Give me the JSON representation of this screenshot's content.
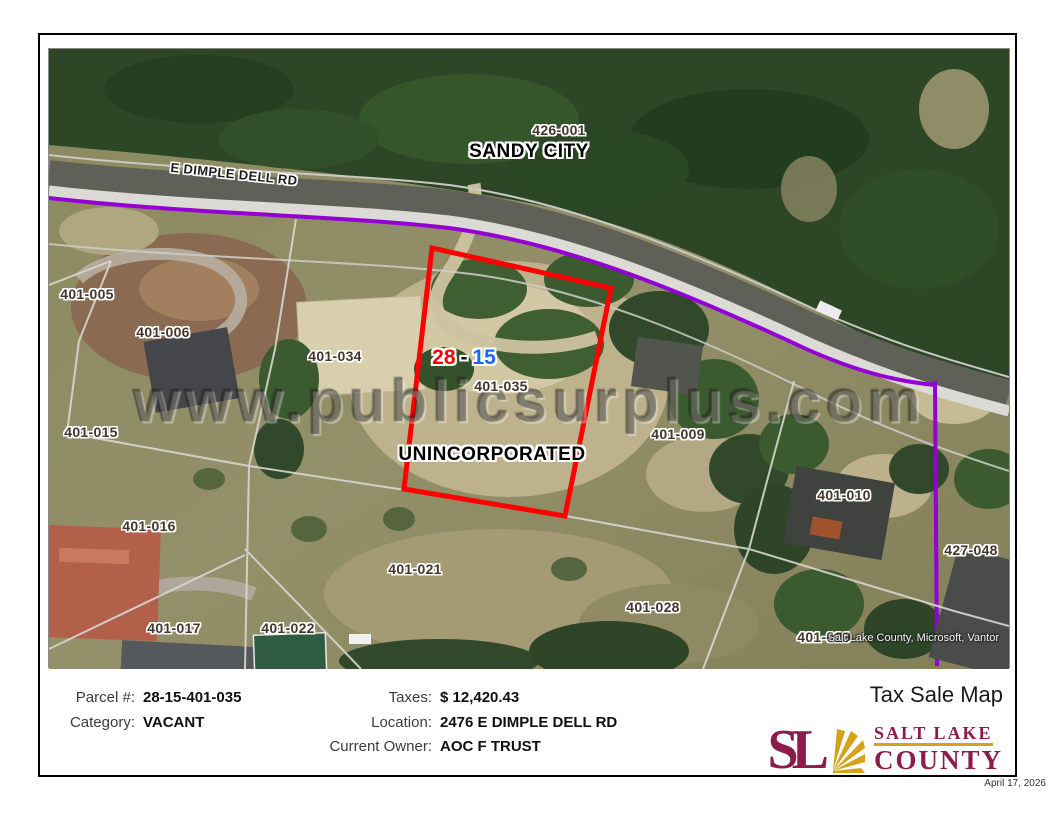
{
  "map": {
    "watermark": "www.publicsurplus.com",
    "city_label": "SANDY CITY",
    "area_label": "UNINCORPORATED",
    "road_label": "E DIMPLE DELL RD",
    "attribution": "Salt Lake County, Microsoft, Vantor",
    "highlight": {
      "book": "28",
      "separator": "-",
      "page": "15"
    },
    "parcel_labels": [
      {
        "text": "426-001",
        "x": 510,
        "y": 81
      },
      {
        "text": "401-005",
        "x": 38,
        "y": 245
      },
      {
        "text": "401-006",
        "x": 114,
        "y": 283
      },
      {
        "text": "401-034",
        "x": 286,
        "y": 307
      },
      {
        "text": "401-035",
        "x": 452,
        "y": 337
      },
      {
        "text": "401-009",
        "x": 629,
        "y": 385
      },
      {
        "text": "401-015",
        "x": 42,
        "y": 383
      },
      {
        "text": "401-010",
        "x": 795,
        "y": 446
      },
      {
        "text": "427-048",
        "x": 922,
        "y": 501
      },
      {
        "text": "401-016",
        "x": 100,
        "y": 477
      },
      {
        "text": "401-021",
        "x": 366,
        "y": 520
      },
      {
        "text": "401-028",
        "x": 604,
        "y": 558
      },
      {
        "text": "401-017",
        "x": 125,
        "y": 579
      },
      {
        "text": "401-022",
        "x": 239,
        "y": 579
      },
      {
        "text": "401-029",
        "x": 775,
        "y": 588
      }
    ]
  },
  "info": {
    "fields_left": [
      {
        "label": "Parcel #:",
        "value": "28-15-401-035"
      },
      {
        "label": "Category:",
        "value": "VACANT"
      }
    ],
    "fields_right": [
      {
        "label": "Taxes:",
        "value": "$ 12,420.43"
      },
      {
        "label": "Location:",
        "value": "2476 E DIMPLE DELL RD"
      },
      {
        "label": "Current Owner:",
        "value": "AOC F TRUST"
      }
    ],
    "title": "Tax Sale Map",
    "logo": {
      "monogram": "SL",
      "name_line1": "SALT LAKE",
      "name_line2": "COUNTY"
    },
    "date": "April 17, 2026"
  },
  "colors": {
    "highlight_outline": "#ff0000",
    "boundary_purple": "#9400d3",
    "brand_maroon": "#8e1b4b",
    "brand_gold": "#d5a21a",
    "book_red": "#ff0000",
    "page_blue": "#1668ff"
  }
}
